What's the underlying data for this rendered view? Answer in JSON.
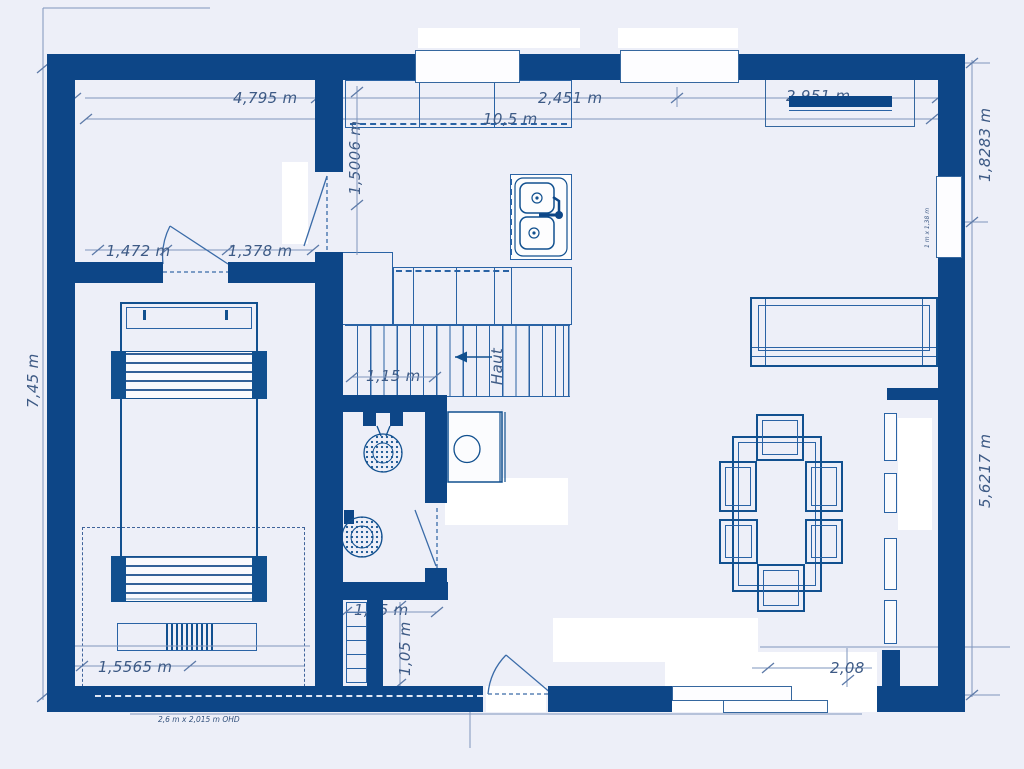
{
  "colors": {
    "wall": "#0d4687",
    "furniture_line": "#11508f",
    "line_light": "#2a63a5",
    "dimension_line": "#7e95bd",
    "dimension_text": "#3d5a85",
    "background": "#edeff8"
  },
  "dimensions": {
    "top_left_room_width": "4,795 m",
    "top_kitchen_width": "2,451 m",
    "top_right_width": "2,951 m",
    "overall_width": "10,5 m",
    "overall_height": "7,45 m",
    "right_upper_height": "1,8283 m",
    "right_lower_height": "5,6217 m",
    "kitchen_depth": "1,5006 m",
    "left_door_left": "1,472 m",
    "left_door_right": "1,378 m",
    "stairs_width": "1,15 m",
    "hall_width": "1,15 m",
    "hall_depth": "1,05 m",
    "bottom_left_width": "1,5565 m",
    "bottom_right_width": "2,08"
  },
  "labels": {
    "stairs_up": "Haut",
    "right_window_size": "1 m x 1,38 m",
    "garage_door_note": "2,6 m x 2,015 m OHD"
  }
}
